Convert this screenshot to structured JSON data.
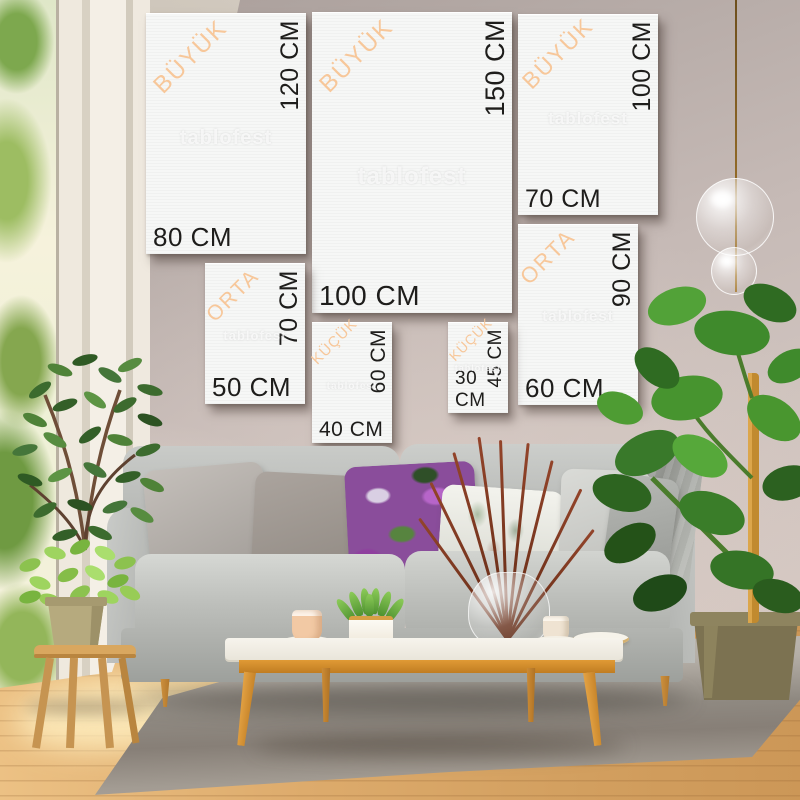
{
  "brand_watermark": "tablofest",
  "size_categories": {
    "large": "BÜYÜK",
    "medium": "ORTA",
    "small": "KÜÇÜK"
  },
  "canvases": [
    {
      "id": "80x120",
      "category": "BÜYÜK",
      "width_label": "80 CM",
      "height_label": "120 CM",
      "watermark": "tablofest"
    },
    {
      "id": "100x150",
      "category": "BÜYÜK",
      "width_label": "100 CM",
      "height_label": "150 CM",
      "watermark": "tablofest"
    },
    {
      "id": "70x100",
      "category": "BÜYÜK",
      "width_label": "70 CM",
      "height_label": "100 CM",
      "watermark": "tablofest"
    },
    {
      "id": "60x90",
      "category": "ORTA",
      "width_label": "60 CM",
      "height_label": "90 CM",
      "watermark": "tablofest"
    },
    {
      "id": "50x70",
      "category": "ORTA",
      "width_label": "50 CM",
      "height_label": "70 CM",
      "watermark": "tablofest"
    },
    {
      "id": "40x60",
      "category": "KÜÇÜK",
      "width_label": "40 CM",
      "height_label": "60 CM",
      "watermark": "tablofest"
    },
    {
      "id": "30x45",
      "category": "KÜÇÜK",
      "width_label": "30 CM",
      "height_label": "45 CM",
      "watermark": "tablofest"
    }
  ],
  "colors": {
    "category_label": "#f7c79a",
    "dimension_label": "#1e1d1b",
    "canvas_face": "#f6f7f6",
    "wall": "#c8bcb8",
    "sofa_grey": "#b9bbb8",
    "wood_accent": "#dd9a3c",
    "rug_grey": "#8f8981",
    "floor_wood": "#ddab6c",
    "foliage_green": "#4e8f33"
  }
}
